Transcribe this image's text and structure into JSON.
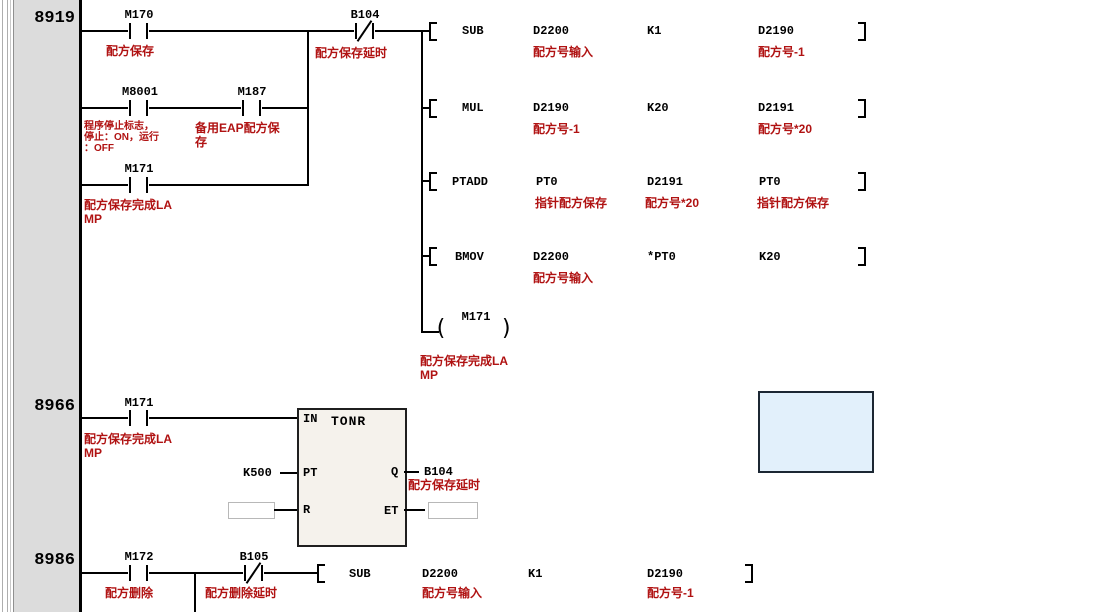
{
  "colors": {
    "comment_red": "#b01212",
    "gutter_gray": "#dcdcdc",
    "block_fill": "#f5f2ec",
    "highlight_fill": "#e2f0fb"
  },
  "rung1": {
    "number": "8919",
    "m170": {
      "label": "M170",
      "comment": "配方保存"
    },
    "b104": {
      "label": "B104",
      "comment": "配方保存延时"
    },
    "m8001": {
      "label": "M8001",
      "c1": "程序停止标志，",
      "c2": "停止：ON，运行",
      "c3": "：OFF"
    },
    "m187": {
      "label": "M187",
      "c1": "备用EAP配方保",
      "c2": "存"
    },
    "m171": {
      "label": "M171",
      "c1": "配方保存完成LA",
      "c2": "MP"
    },
    "rows": [
      {
        "op": "SUB",
        "a1": "D2200",
        "a1c": "配方号输入",
        "a2": "K1",
        "a3": "D2190",
        "a3c": "配方号-1"
      },
      {
        "op": "MUL",
        "a1": "D2190",
        "a1c": "配方号-1",
        "a2": "K20",
        "a3": "D2191",
        "a3c": "配方号*20"
      },
      {
        "op": "PTADD",
        "a1": "PT0",
        "a1c": "指针配方保存",
        "a2": "D2191",
        "a2c": "配方号*20",
        "a3": "PT0",
        "a3c": "指针配方保存"
      },
      {
        "op": "BMOV",
        "a1": "D2200",
        "a1c": "配方号输入",
        "a2": "*PT0",
        "a3": "K20"
      }
    ],
    "coil": {
      "label": "M171",
      "c1": "配方保存完成LA",
      "c2": "MP"
    }
  },
  "rung2": {
    "number": "8966",
    "m171": {
      "label": "M171",
      "c1": "配方保存完成LA",
      "c2": "MP"
    },
    "block": {
      "title": "TONR",
      "in_label": "IN",
      "pt_label": "PT",
      "r_label": "R",
      "q_label": "Q",
      "et_label": "ET"
    },
    "pt_value": "K500",
    "q_out": {
      "label": "B104",
      "comment": "配方保存延时"
    }
  },
  "rung3": {
    "number": "8986",
    "m172": {
      "label": "M172",
      "comment": "配方删除"
    },
    "b105": {
      "label": "B105",
      "comment": "配方删除延时"
    },
    "row": {
      "op": "SUB",
      "a1": "D2200",
      "a1c": "配方号输入",
      "a2": "K1",
      "a3": "D2190",
      "a3c": "配方号-1"
    }
  }
}
